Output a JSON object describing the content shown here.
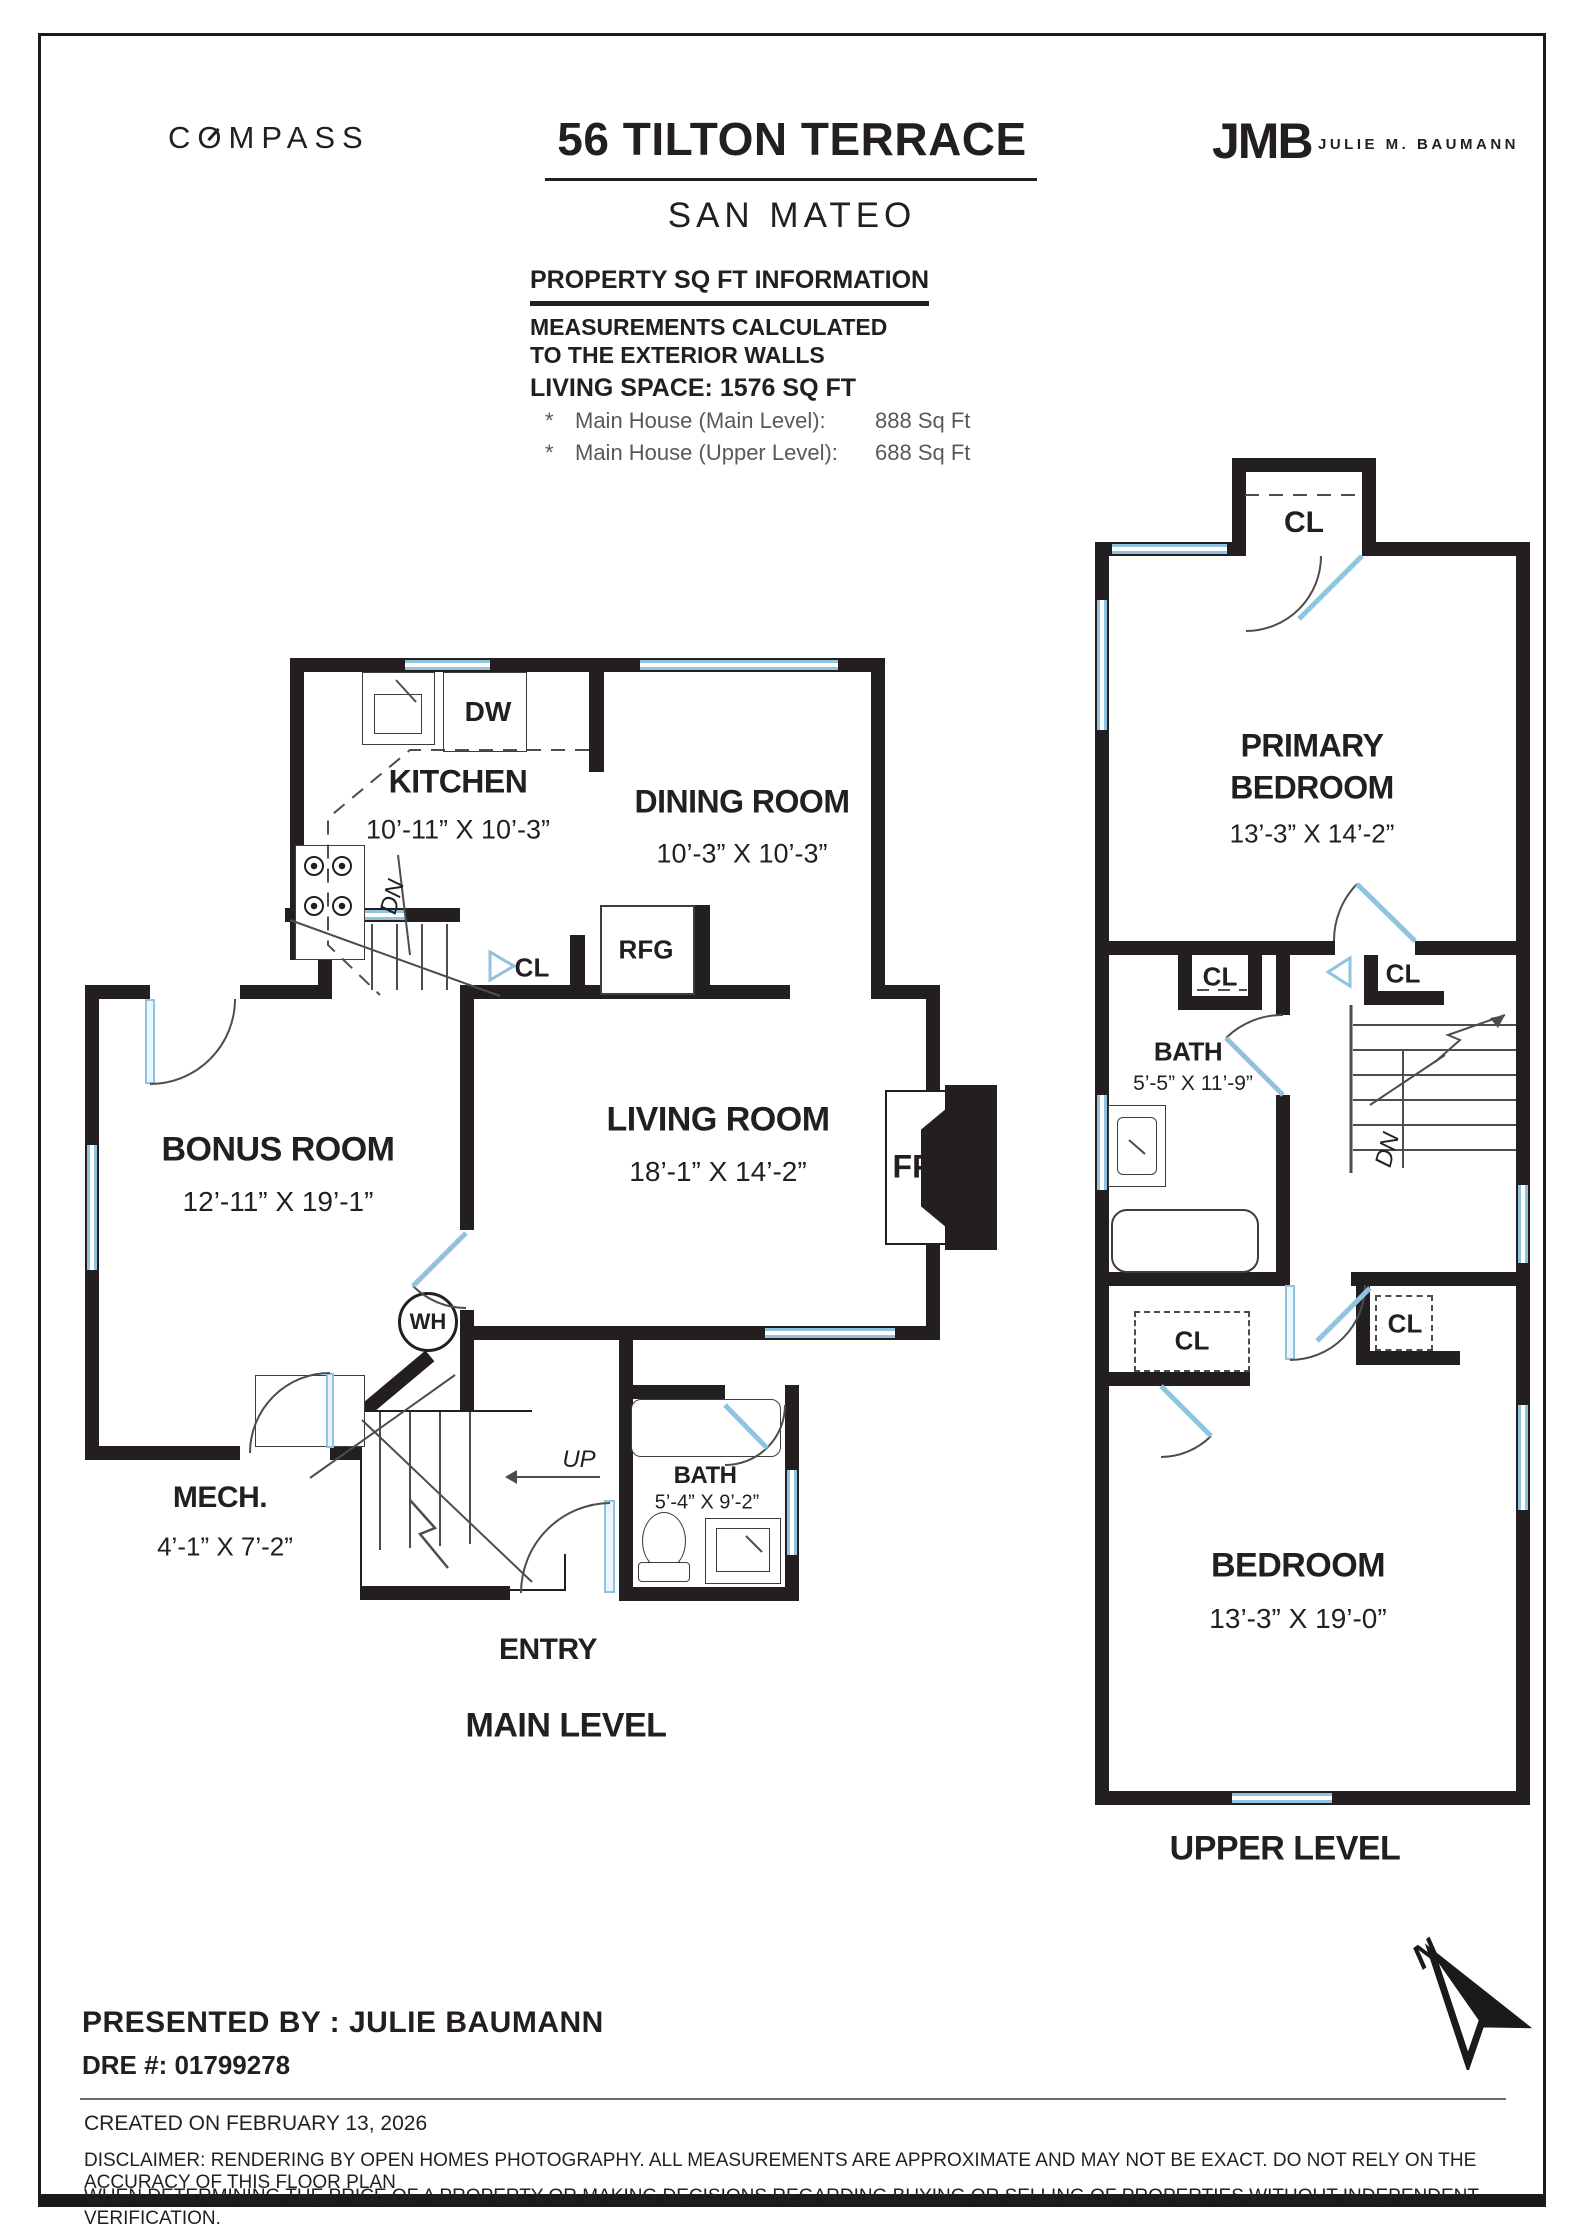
{
  "header": {
    "brand": "COMPASS",
    "title": "56 TILTON TERRACE",
    "subtitle": "SAN MATEO",
    "agent_logo_initials": "JMB",
    "agent_logo_name": "JULIE M. BAUMANN"
  },
  "property_info": {
    "heading": "PROPERTY SQ FT INFORMATION",
    "note_line1": "MEASUREMENTS CALCULATED",
    "note_line2": "TO THE EXTERIOR WALLS",
    "living_space": "LIVING SPACE: 1576 SQ FT",
    "breakdown": [
      {
        "bullet": "*",
        "label": "Main House (Main Level):",
        "value": "888 Sq Ft"
      },
      {
        "bullet": "*",
        "label": "Main House (Upper Level):",
        "value": "688 Sq Ft"
      }
    ]
  },
  "main_level": {
    "level_label": "MAIN LEVEL",
    "entry_label": "ENTRY",
    "kitchen": {
      "name": "KITCHEN",
      "dims": "10’-11” X 10’-3”"
    },
    "dining": {
      "name": "DINING ROOM",
      "dims": "10’-3” X 10’-3”"
    },
    "living": {
      "name": "LIVING ROOM",
      "dims": "18’-1” X 14’-2”"
    },
    "bonus": {
      "name": "BONUS ROOM",
      "dims": "12’-11” X 19’-1”"
    },
    "mech": {
      "name": "MECH.",
      "dims": "4’-1” X 7’-2”"
    },
    "bath": {
      "name": "BATH",
      "dims": "5’-4” X 9’-2”"
    },
    "fixtures": {
      "dishwasher": "DW",
      "refrigerator": "RFG",
      "closet": "CL",
      "water_heater": "WH",
      "fireplace": "FP",
      "stairs_up": "UP",
      "stairs_down": "DN"
    }
  },
  "upper_level": {
    "level_label": "UPPER LEVEL",
    "primary": {
      "name_line1": "PRIMARY",
      "name_line2": "BEDROOM",
      "dims": "13’-3” X 14’-2”"
    },
    "bath": {
      "name": "BATH",
      "dims": "5’-5” X 11’-9”"
    },
    "bedroom": {
      "name": "BEDROOM",
      "dims": "13’-3” X 19’-0”"
    },
    "closet_label": "CL",
    "stairs_down": "DN"
  },
  "footer": {
    "presented_by": "PRESENTED BY : JULIE BAUMANN",
    "dre": "DRE #: 01799278",
    "created": "CREATED ON FEBRUARY 13, 2026",
    "disclaimer_line1": "DISCLAIMER: RENDERING BY OPEN HOMES PHOTOGRAPHY. ALL MEASUREMENTS ARE APPROXIMATE AND MAY NOT BE EXACT. DO NOT RELY ON THE ACCURACY OF THIS FLOOR PLAN",
    "disclaimer_line2": "WHEN DETERMINING THE PRICE OF A PROPERTY OR MAKING DECISIONS REGARDING BUYING OR SELLING OF PROPERTIES WITHOUT INDEPENDENT VERIFICATION.",
    "north_label": "N"
  },
  "colors": {
    "wall": "#231f20",
    "window_blue": "#8fc3df",
    "note_gray": "#58595b"
  }
}
